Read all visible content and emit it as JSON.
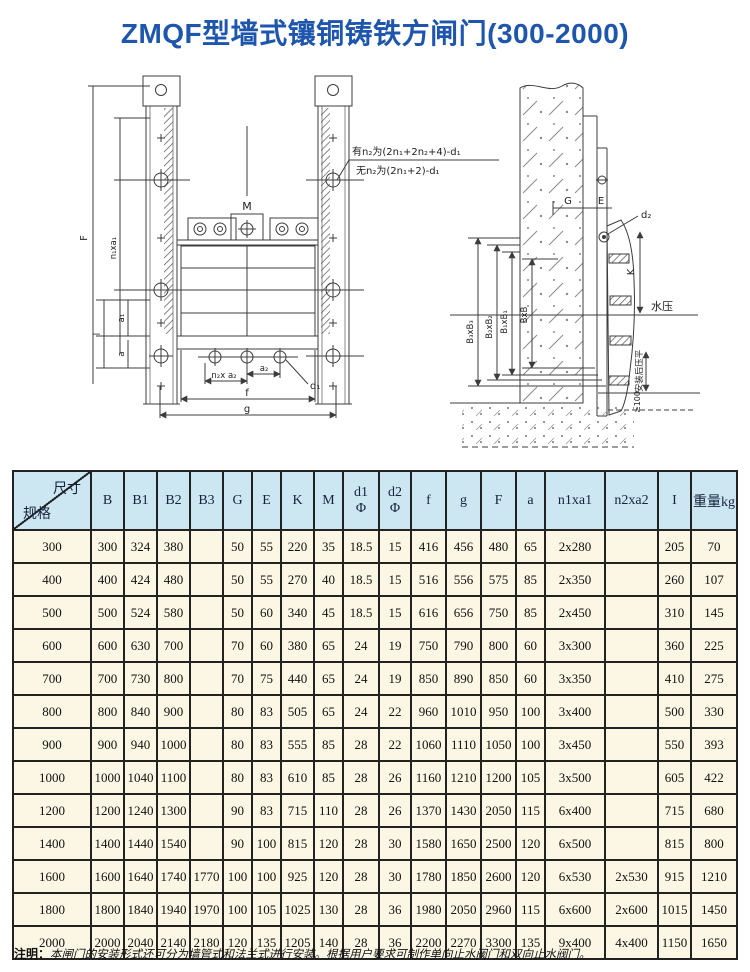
{
  "page": {
    "title": "ZMQF型墙式镶铜铸铁方闸门(300-2000)"
  },
  "colors": {
    "title_blue": "#1e56ad",
    "header_bg": "#cde7f2",
    "cell_bg": "#fbf7e4"
  },
  "drawings": {
    "front_view": {
      "labels": {
        "M": "M",
        "F": "F",
        "n1xa1": "n₁xa₁",
        "l": "l",
        "a1": "a₁",
        "a": "a",
        "n2xa2": "n₂x a₂",
        "a2": "a₂",
        "d1": "d₁",
        "f": "f",
        "g": "g",
        "note_with_n2": "有n₂为(2n₁+2n₂+4)-d₁",
        "note_without_n2": "无n₂为(2n₁+2)-d₁"
      }
    },
    "side_view": {
      "labels": {
        "G": "G",
        "E": "E",
        "d2": "d₂",
        "K": "K",
        "water": "水压",
        "B3": "B₃xB₃",
        "B2": "B₂xB₂",
        "B1": "B₁xB₁",
        "B": "BxB",
        "flatten": "安装后压平",
        "min100": "≥100"
      }
    }
  },
  "table": {
    "corner_top": "尺寸",
    "corner_bottom": "规格",
    "headers": [
      "B",
      "B1",
      "B2",
      "B3",
      "G",
      "E",
      "K",
      "M",
      "d1\nΦ",
      "d2\nΦ",
      "f",
      "g",
      "F",
      "a",
      "n1xa1",
      "n2xa2",
      "I",
      "重量kg"
    ],
    "rows": [
      {
        "spec": "300",
        "cells": [
          "300",
          "324",
          "380",
          "",
          "50",
          "55",
          "220",
          "35",
          "18.5",
          "15",
          "416",
          "456",
          "480",
          "65",
          "2x280",
          "",
          "205",
          "70"
        ]
      },
      {
        "spec": "400",
        "cells": [
          "400",
          "424",
          "480",
          "",
          "50",
          "55",
          "270",
          "40",
          "18.5",
          "15",
          "516",
          "556",
          "575",
          "85",
          "2x350",
          "",
          "260",
          "107"
        ]
      },
      {
        "spec": "500",
        "cells": [
          "500",
          "524",
          "580",
          "",
          "50",
          "60",
          "340",
          "45",
          "18.5",
          "15",
          "616",
          "656",
          "750",
          "85",
          "2x450",
          "",
          "310",
          "145"
        ]
      },
      {
        "spec": "600",
        "cells": [
          "600",
          "630",
          "700",
          "",
          "70",
          "60",
          "380",
          "65",
          "24",
          "19",
          "750",
          "790",
          "800",
          "60",
          "3x300",
          "",
          "360",
          "225"
        ]
      },
      {
        "spec": "700",
        "cells": [
          "700",
          "730",
          "800",
          "",
          "70",
          "75",
          "440",
          "65",
          "24",
          "19",
          "850",
          "890",
          "850",
          "60",
          "3x350",
          "",
          "410",
          "275"
        ]
      },
      {
        "spec": "800",
        "cells": [
          "800",
          "840",
          "900",
          "",
          "80",
          "83",
          "505",
          "65",
          "24",
          "22",
          "960",
          "1010",
          "950",
          "100",
          "3x400",
          "",
          "500",
          "330"
        ]
      },
      {
        "spec": "900",
        "cells": [
          "900",
          "940",
          "1000",
          "",
          "80",
          "83",
          "555",
          "85",
          "28",
          "22",
          "1060",
          "1110",
          "1050",
          "100",
          "3x450",
          "",
          "550",
          "393"
        ]
      },
      {
        "spec": "1000",
        "cells": [
          "1000",
          "1040",
          "1100",
          "",
          "80",
          "83",
          "610",
          "85",
          "28",
          "26",
          "1160",
          "1210",
          "1200",
          "105",
          "3x500",
          "",
          "605",
          "422"
        ]
      },
      {
        "spec": "1200",
        "cells": [
          "1200",
          "1240",
          "1300",
          "",
          "90",
          "83",
          "715",
          "110",
          "28",
          "26",
          "1370",
          "1430",
          "2050",
          "115",
          "6x400",
          "",
          "715",
          "680"
        ]
      },
      {
        "spec": "1400",
        "cells": [
          "1400",
          "1440",
          "1540",
          "",
          "90",
          "100",
          "815",
          "120",
          "28",
          "30",
          "1580",
          "1650",
          "2500",
          "120",
          "6x500",
          "",
          "815",
          "800"
        ]
      },
      {
        "spec": "1600",
        "cells": [
          "1600",
          "1640",
          "1740",
          "1770",
          "100",
          "100",
          "925",
          "120",
          "28",
          "30",
          "1780",
          "1850",
          "2600",
          "120",
          "6x530",
          "2x530",
          "915",
          "1210"
        ]
      },
      {
        "spec": "1800",
        "cells": [
          "1800",
          "1840",
          "1940",
          "1970",
          "100",
          "105",
          "1025",
          "130",
          "28",
          "36",
          "1980",
          "2050",
          "2960",
          "115",
          "6x600",
          "2x600",
          "1015",
          "1450"
        ]
      },
      {
        "spec": "2000",
        "cells": [
          "2000",
          "2040",
          "2140",
          "2180",
          "120",
          "135",
          "1205",
          "140",
          "28",
          "36",
          "2200",
          "2270",
          "3300",
          "135",
          "9x400",
          "4x400",
          "1150",
          "1650"
        ]
      }
    ]
  },
  "note": {
    "label": "注明：",
    "text": "本闸门的安装形式还可分为墙管式和法兰式进行安装。根据用户要求可制作单向止水阀门和双向止水阀门。"
  }
}
